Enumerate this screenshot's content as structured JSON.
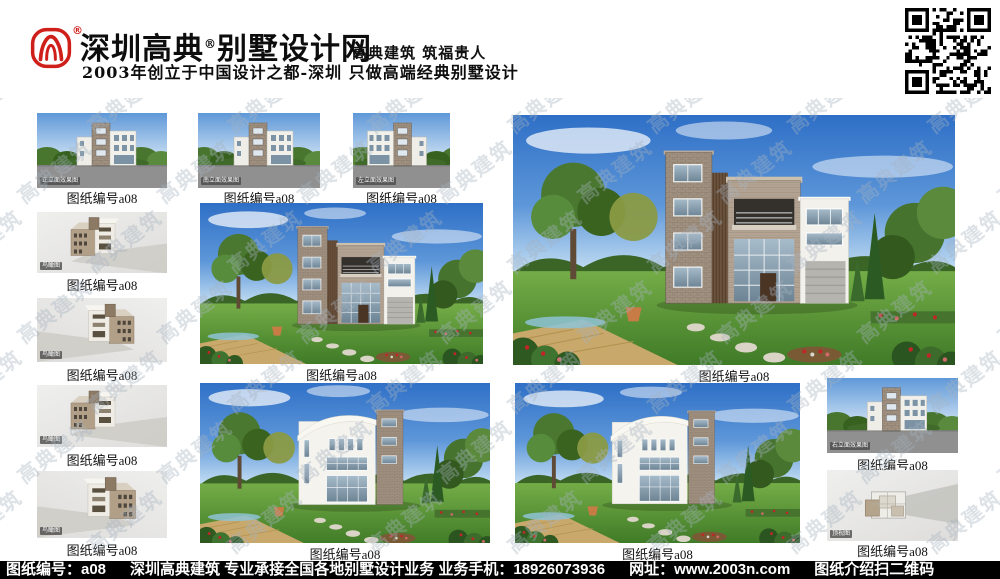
{
  "header": {
    "brand_name_part1": "深圳高典",
    "registered_mark": "®",
    "brand_name_part2": "别墅设计网",
    "tagline": "高典建筑 筑福贵人",
    "subtitle": "2003年创立于中国设计之都-深圳 只做高端经典别墅设计"
  },
  "labels": {
    "caption": "图纸编号a08"
  },
  "badges": {
    "front_elevation": "正立面效果图",
    "south_elevation": "南立面效果图",
    "left_elevation": "左立面效果图",
    "right_elevation": "右立面效果图",
    "birdseye_view": "鸟瞰图",
    "top_view": "顶视图"
  },
  "watermark": {
    "text": "高典建筑"
  },
  "footer": {
    "drawing_no": "图纸编号：a08",
    "business": "深圳高典建筑 专业承接全国各地别墅设计业务 业务手机：18926073936",
    "website": "网址：www.2003n.com",
    "qr_hint": "图纸介绍扫二维码"
  },
  "colors": {
    "brand_red": "#cf1f1a",
    "footer_bg": "#000000",
    "sky_blue": "#2e6fc6",
    "lawn_green": "#4f8a2e"
  }
}
